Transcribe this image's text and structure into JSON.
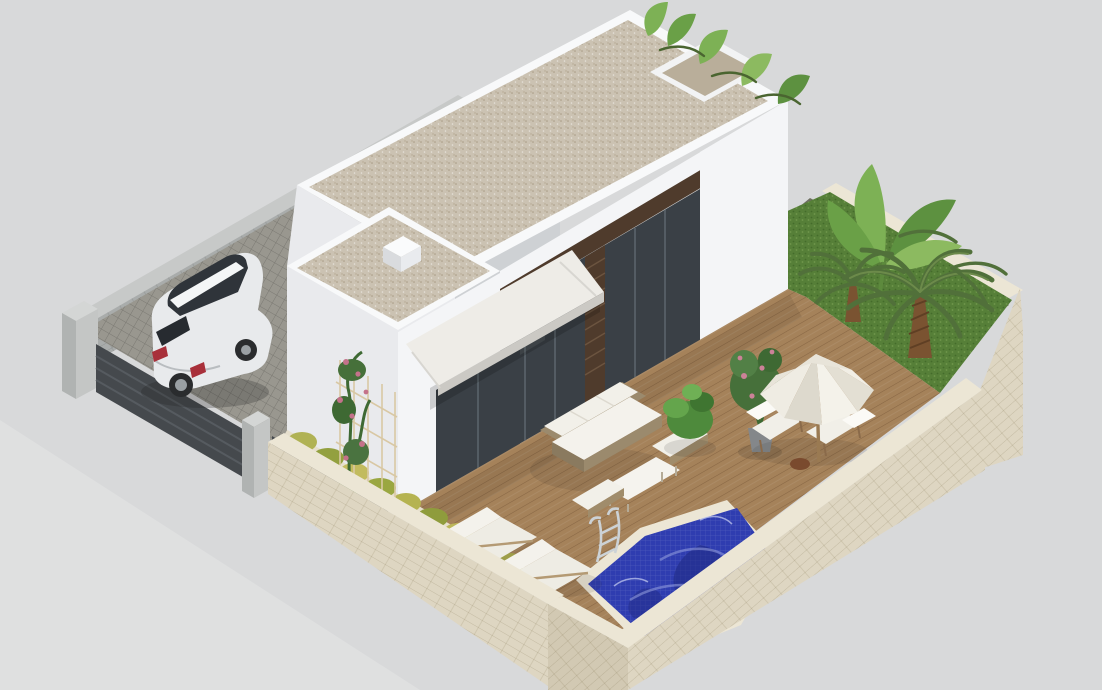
{
  "scene": {
    "type": "3d-architectural-render",
    "description": "Isometric aerial rendering of a modern single-storey white villa on a walled plot with gravel flat roofs, cobbled driveway with a silver SUV, wooden pool deck with white garden furniture and parasol, blue mosaic swimming pool with ladder, climbing roses, shrub planter, and a lawn garden with palm and banana trees",
    "objects": [
      {
        "id": "villa",
        "label": "modern white villa with flat gravel roofs and parapets"
      },
      {
        "id": "chimney",
        "label": "white chimney box on lower roof"
      },
      {
        "id": "glazing",
        "label": "dark glass sliding doors with wood slat cladding"
      },
      {
        "id": "awning",
        "label": "white retractable awning"
      },
      {
        "id": "trellis",
        "label": "climbing rose trellis on side wall"
      },
      {
        "id": "planter",
        "label": "yellow-green shrub planter along front wall"
      },
      {
        "id": "perimeter-wall",
        "label": "cream stone perimeter wall"
      },
      {
        "id": "fence",
        "label": "dark slat entrance fence with stone pillars"
      },
      {
        "id": "driveway",
        "label": "cobblestone driveway"
      },
      {
        "id": "car",
        "label": "silver SUV parked in driveway"
      },
      {
        "id": "deck",
        "label": "wooden pool deck"
      },
      {
        "id": "sofa-set",
        "label": "white rattan garden sofa set with table and ottomans"
      },
      {
        "id": "loungers",
        "label": "two white sun loungers"
      },
      {
        "id": "parasol",
        "label": "white parasol with two deck chairs"
      },
      {
        "id": "potted-plants",
        "label": "potted rose bush and green shrub"
      },
      {
        "id": "pool",
        "label": "blue mosaic swimming pool"
      },
      {
        "id": "ladder",
        "label": "stainless steel pool ladder"
      },
      {
        "id": "garden",
        "label": "lawn garden with palm trees and banana plants"
      }
    ]
  },
  "palette": {
    "bg": "#d8d9da",
    "stone_top": "#c7c9c8",
    "stone_face": "#a9acab",
    "fence": "#45494d",
    "pillar_light": "#d4d6d5",
    "pillar_dark": "#b0b3b2",
    "cream_top": "#ece6d5",
    "cream_face": "#ded6c2",
    "cream_dark": "#d2c9b3",
    "cobble": "#99978f",
    "white_lit": "#f4f5f7",
    "white_mid": "#e9eaed",
    "white_shadow": "#ced1d4",
    "parapet": "#f8f9fa",
    "gravel": "#cbc2b2",
    "gravel_dark": "#b9ae9a",
    "glass": "#3a4046",
    "wood": "#4f3b2c",
    "awning_light": "#eeece7",
    "deck": "#a5825a",
    "pool": "#2f3db0",
    "pool_dark": "#222c86",
    "pool_light": "#97a2e0",
    "lawn": "#567f38",
    "trunk": "#7a5331",
    "frond": "#506f35",
    "frond_dark": "#3e5829",
    "banana": "#7db155",
    "banana_dark": "#5d9140",
    "rose": "#c4728a",
    "rose_leaf": "#3e6933",
    "shrub": "#adad4e",
    "car_body": "#e8eaec",
    "car_glass": "#2f343a",
    "cushion": "#f2f0e9",
    "wicker": "#9b8a6d",
    "chrome": "#ccd2d6",
    "parasol": "#efece3",
    "pot": "#84878a"
  }
}
